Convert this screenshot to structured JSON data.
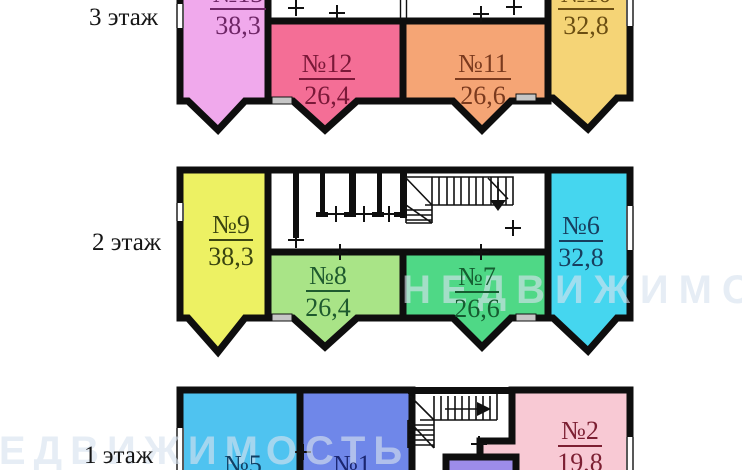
{
  "page": {
    "background": "#ffffff",
    "wall_color": "#0e0e0e",
    "sill_color": "#c6c6c6"
  },
  "watermark": {
    "text": "НЕДВИЖИМОСТЬ"
  },
  "floors": [
    {
      "label": "3 этаж",
      "rooms": [
        {
          "num": "№13",
          "area": "38,3",
          "fill": "#F0A9EC",
          "text_color": "#6E2566"
        },
        {
          "num": "№12",
          "area": "26,4",
          "fill": "#F46E96",
          "text_color": "#7A1838"
        },
        {
          "num": "№11",
          "area": "26,6",
          "fill": "#F5A575",
          "text_color": "#7A3A1E"
        },
        {
          "num": "№10",
          "area": "32,8",
          "fill": "#F5D476",
          "text_color": "#6B4E12"
        }
      ]
    },
    {
      "label": "2 этаж",
      "rooms": [
        {
          "num": "№9",
          "area": "38,3",
          "fill": "#EDF163",
          "text_color": "#39430F"
        },
        {
          "num": "№8",
          "area": "26,4",
          "fill": "#A9E487",
          "text_color": "#1E5A2E"
        },
        {
          "num": "№7",
          "area": "26,6",
          "fill": "#4FD886",
          "text_color": "#155C30"
        },
        {
          "num": "№6",
          "area": "32,8",
          "fill": "#45D6EF",
          "text_color": "#173E5E"
        }
      ]
    },
    {
      "label": "1 этаж",
      "rooms": [
        {
          "num": "№5",
          "area": "",
          "fill": "#4FC3F0",
          "text_color": "#113F63"
        },
        {
          "num": "№1",
          "area": "",
          "fill": "#6F87E9",
          "text_color": "#1B2670"
        },
        {
          "num": "№2",
          "area": "19,8",
          "fill": "#F8C9D4",
          "text_color": "#7C1F32"
        },
        {
          "num": "",
          "area": "",
          "fill": "#9C8CE9",
          "text_color": "#000000"
        }
      ]
    }
  ]
}
